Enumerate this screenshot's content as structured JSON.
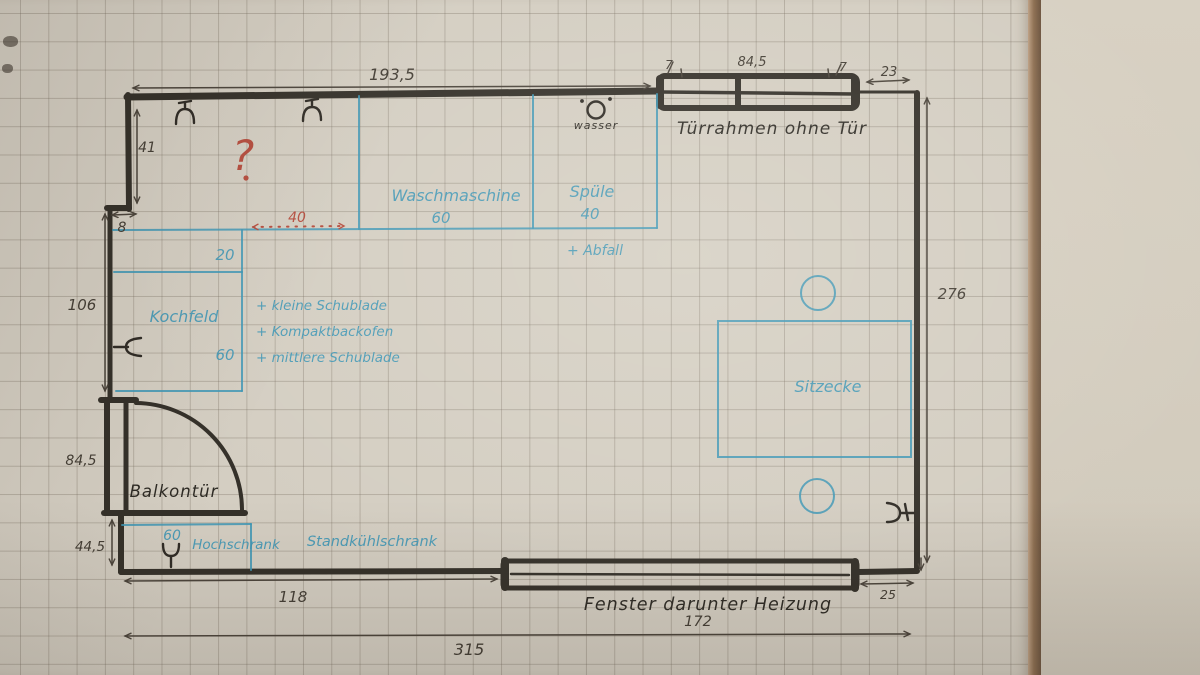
{
  "floorplan": {
    "dims": {
      "top_width": "193,5",
      "wall_41": "41",
      "offset_8": "8",
      "wall_106": "106",
      "door_height": "84,5",
      "wall_44_5": "44,5",
      "bottom_118": "118",
      "total_315": "315",
      "right_276": "276",
      "gap_23": "23",
      "gap_25": "25",
      "window_172": "172",
      "frame_7_left": "7",
      "frame_84_5": "84,5",
      "frame_7_right": "7",
      "red_40": "40"
    },
    "black_labels": {
      "door_frame": "Türrahmen ohne Tür",
      "water": "wasser",
      "balcony_door": "Balkontür",
      "window_heating": "Fenster darunter Heizung"
    },
    "blue_labels": {
      "washing_machine": "Waschmaschine",
      "washing_machine_width": "60",
      "sink": "Spüle",
      "sink_width": "40",
      "waste": "+ Abfall",
      "depth_20": "20",
      "hob": "Kochfeld",
      "hob_width": "60",
      "notes": [
        "+ kleine Schublade",
        "+ Kompaktbackofen",
        "+ mittlere Schublade"
      ],
      "seating": "Sitzecke",
      "cabinet_width": "60",
      "tall_cabinet": "Hochschrank",
      "fridge": "Standkühlschrank"
    },
    "red_labels": {
      "question": "?"
    },
    "colors": {
      "marker": "#343029",
      "pencil": "#4b443b",
      "blue_ink": "#3e96b5",
      "red_ink": "#b54b3c",
      "paper": "#d4cec2",
      "paper_edge": "#8d6f52",
      "desk": "#d6cfc1"
    }
  }
}
